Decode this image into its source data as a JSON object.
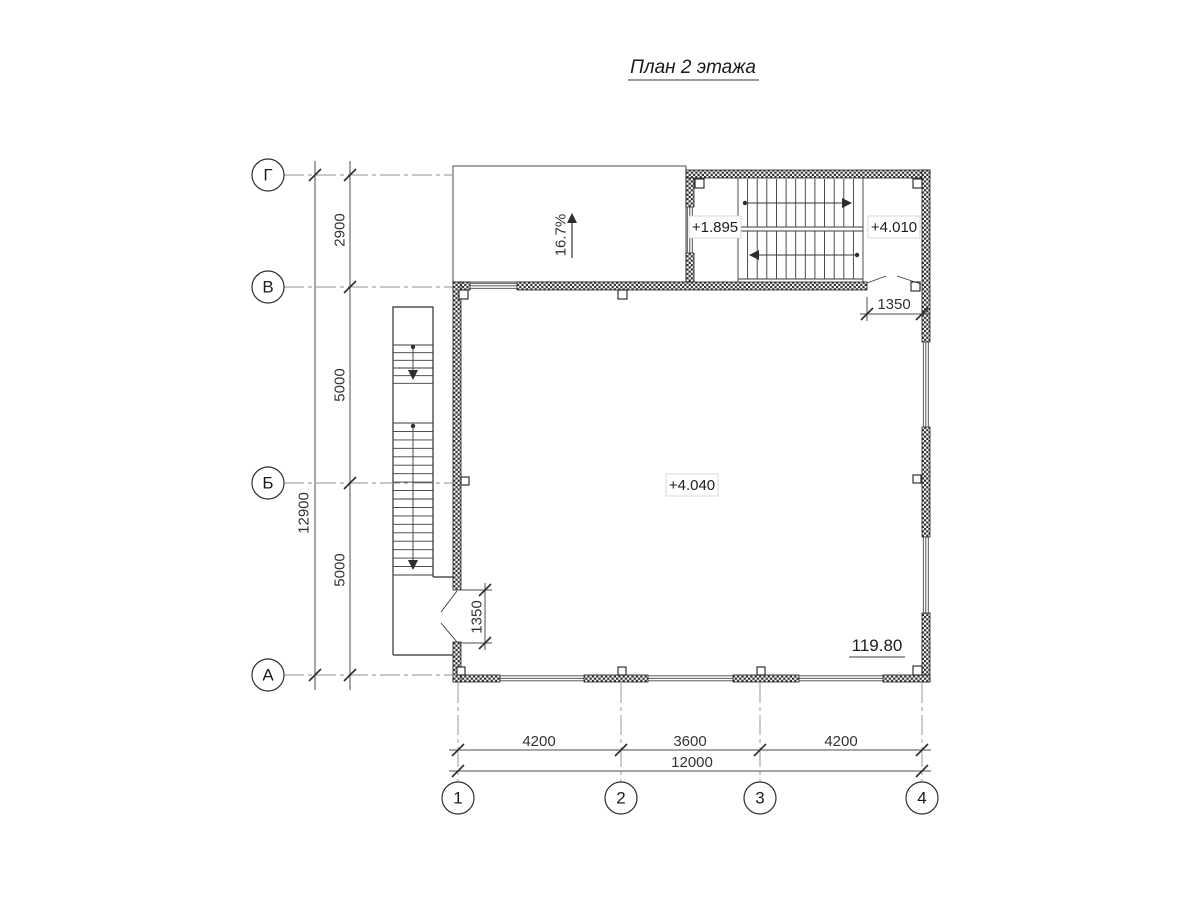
{
  "title": "План 2 этажа",
  "left_axes": {
    "g": "Г",
    "v": "В",
    "b": "Б",
    "a": "А"
  },
  "bottom_axes": {
    "a1": "1",
    "a2": "2",
    "a3": "3",
    "a4": "4"
  },
  "dimensions": {
    "overall_vertical": "12900",
    "span_gv": "2900",
    "span_vb": "5000",
    "span_ba": "5000",
    "span_12": "4200",
    "span_23": "3600",
    "span_34": "4200",
    "overall_horizontal": "12000",
    "door_top": "1350",
    "door_left": "1350"
  },
  "levels": {
    "stair_landing": "+1.895",
    "stair_upper": "+4.010",
    "floor": "+4.040"
  },
  "area_label": "119.80",
  "ramp_slope": "16.7%",
  "colors": {
    "line": "#2e2e2e",
    "dim": "#4d4d4d",
    "axis": "#8f8f8f",
    "background": "#ffffff"
  }
}
